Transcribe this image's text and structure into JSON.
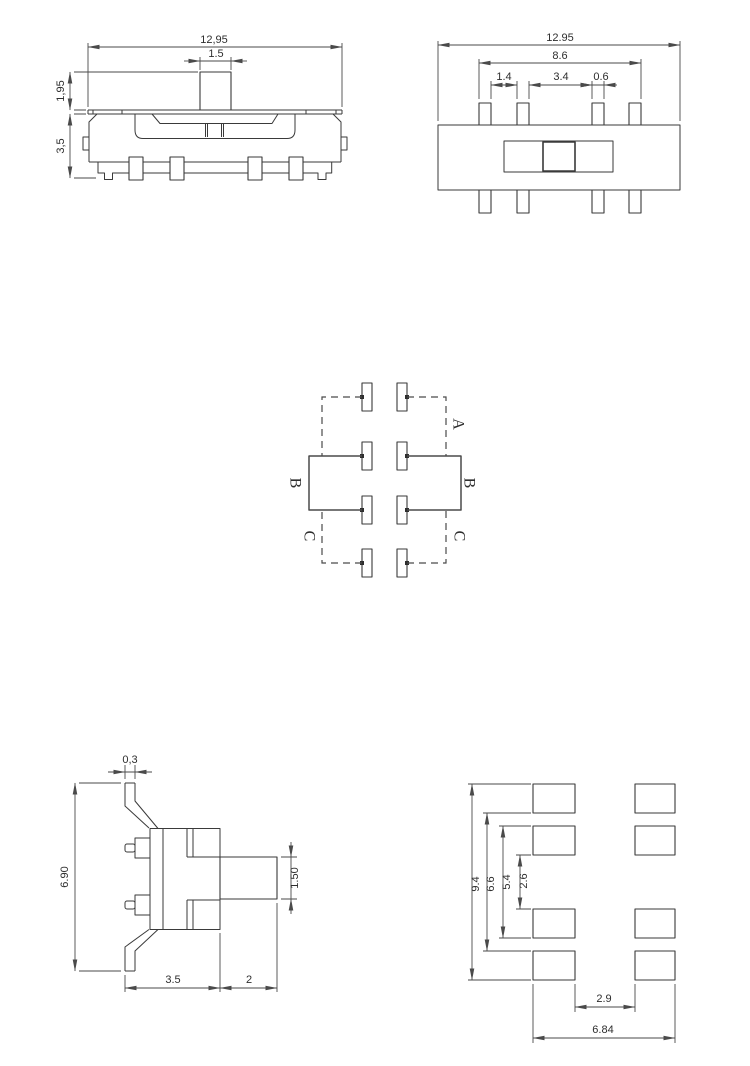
{
  "drawing_line_color": "#3a3a3a",
  "views": {
    "front": {
      "dims": {
        "overall_width": "12,95",
        "knob_width": "1.5",
        "knob_height": "1,95",
        "body_height": "3,5"
      }
    },
    "top": {
      "dims": {
        "overall_width": "12.95",
        "pin_span": "8.6",
        "pin_gap_small": "1.4",
        "pin_gap_large": "3.4",
        "pin_width": "0.6"
      }
    },
    "schematic": {
      "labels": {
        "pos_a": "A",
        "pos_b_left": "B",
        "pos_b_right": "B",
        "pos_c_left": "C",
        "pos_c_right": "C"
      }
    },
    "side": {
      "dims": {
        "bracket_thickness": "0,3",
        "overall_height": "6.90",
        "knob_thickness": "1.50",
        "body_depth": "3.5",
        "knob_length": "2"
      }
    },
    "pcb": {
      "dims": {
        "outer_height": "9.4",
        "mid_height": "6.6",
        "inner_height": "5.4",
        "center_gap": "2.6",
        "bottom_gap": "2.9",
        "overall_width": "6.84"
      }
    }
  }
}
